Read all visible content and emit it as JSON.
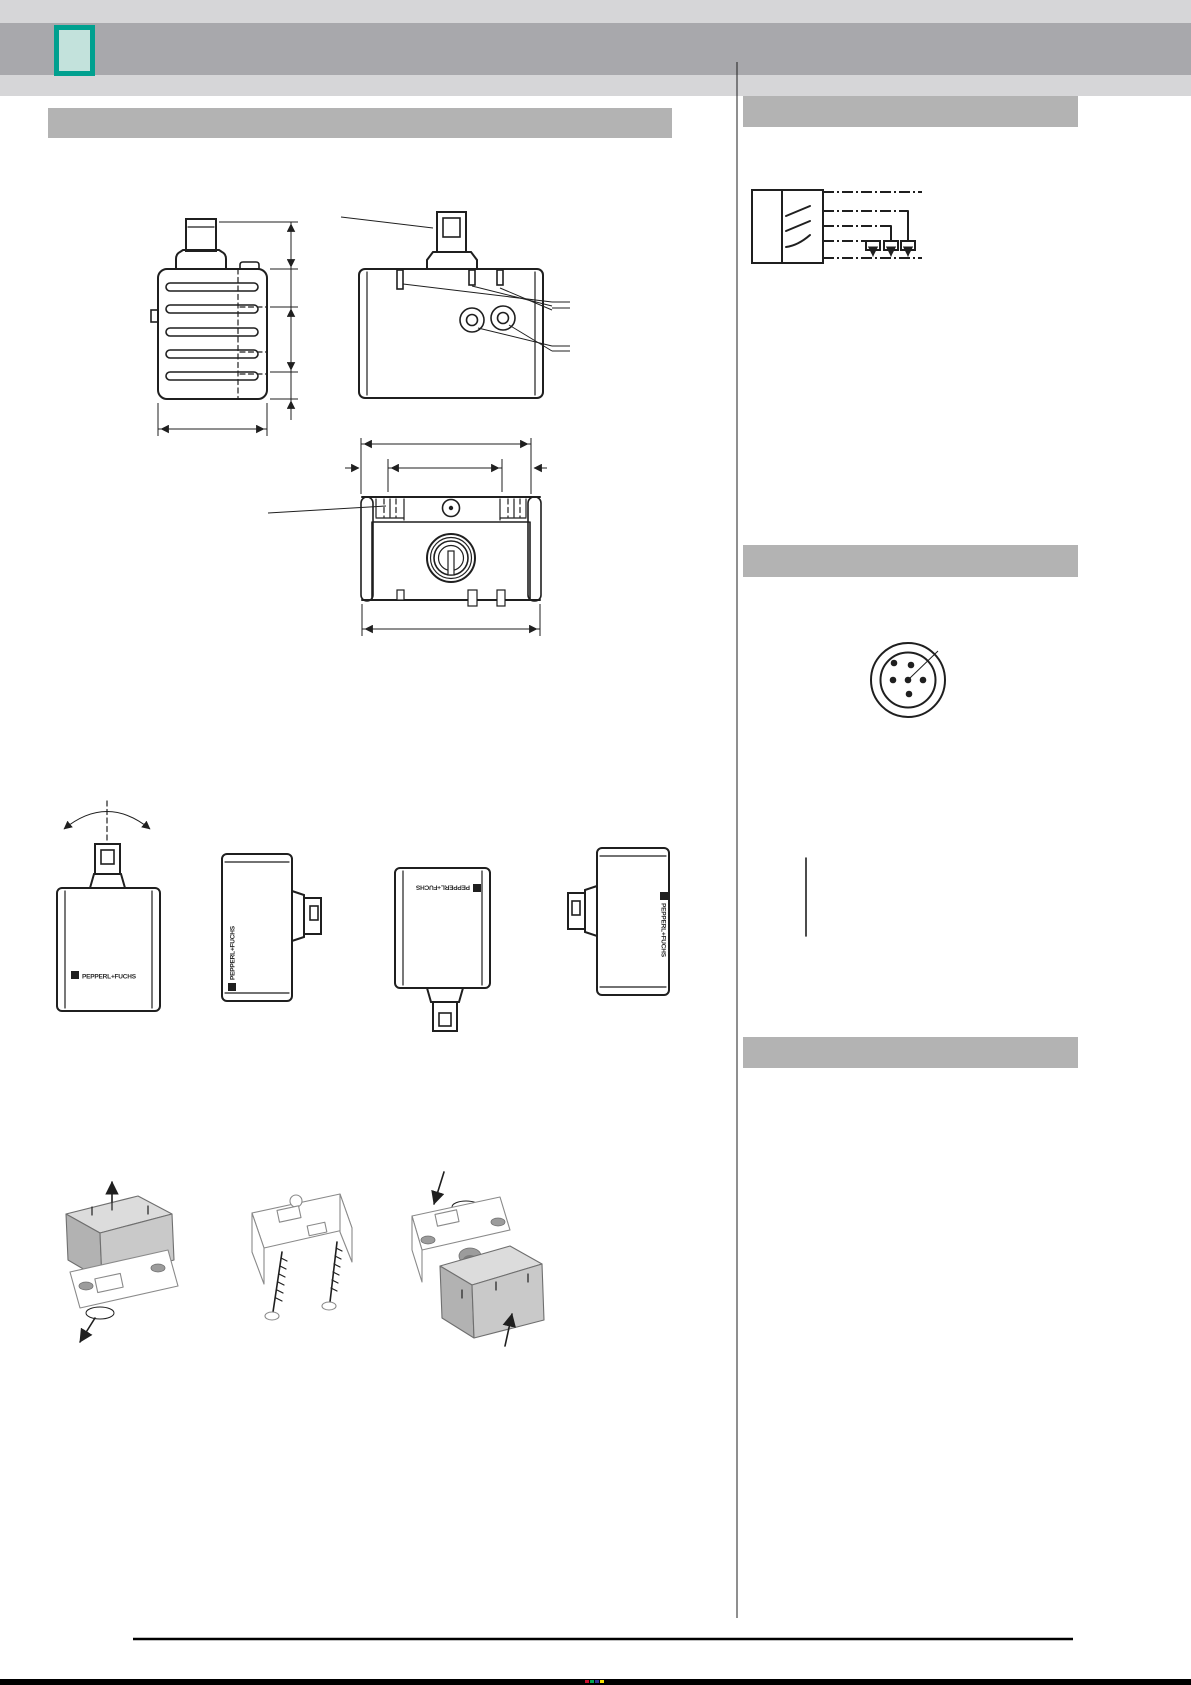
{
  "brand": {
    "logo_text": "PEPPERL+FUCHS"
  },
  "colors": {
    "accent_teal": "#00A08F",
    "accent_teal_fill": "#C3E2DC",
    "band_dark": "#A8A8AC",
    "band_light": "#D6D6D8",
    "section_bar": "#B3B3B3",
    "line": "#1F1F1F",
    "figure_gray_light": "#DCDCDC",
    "figure_gray_mid": "#C9C9C9",
    "figure_gray_dark": "#B2B2B2",
    "pm_red": "#C8102E",
    "pm_green": "#00A651",
    "pm_blue": "#2E3192",
    "pm_yellow": "#F5E000"
  }
}
